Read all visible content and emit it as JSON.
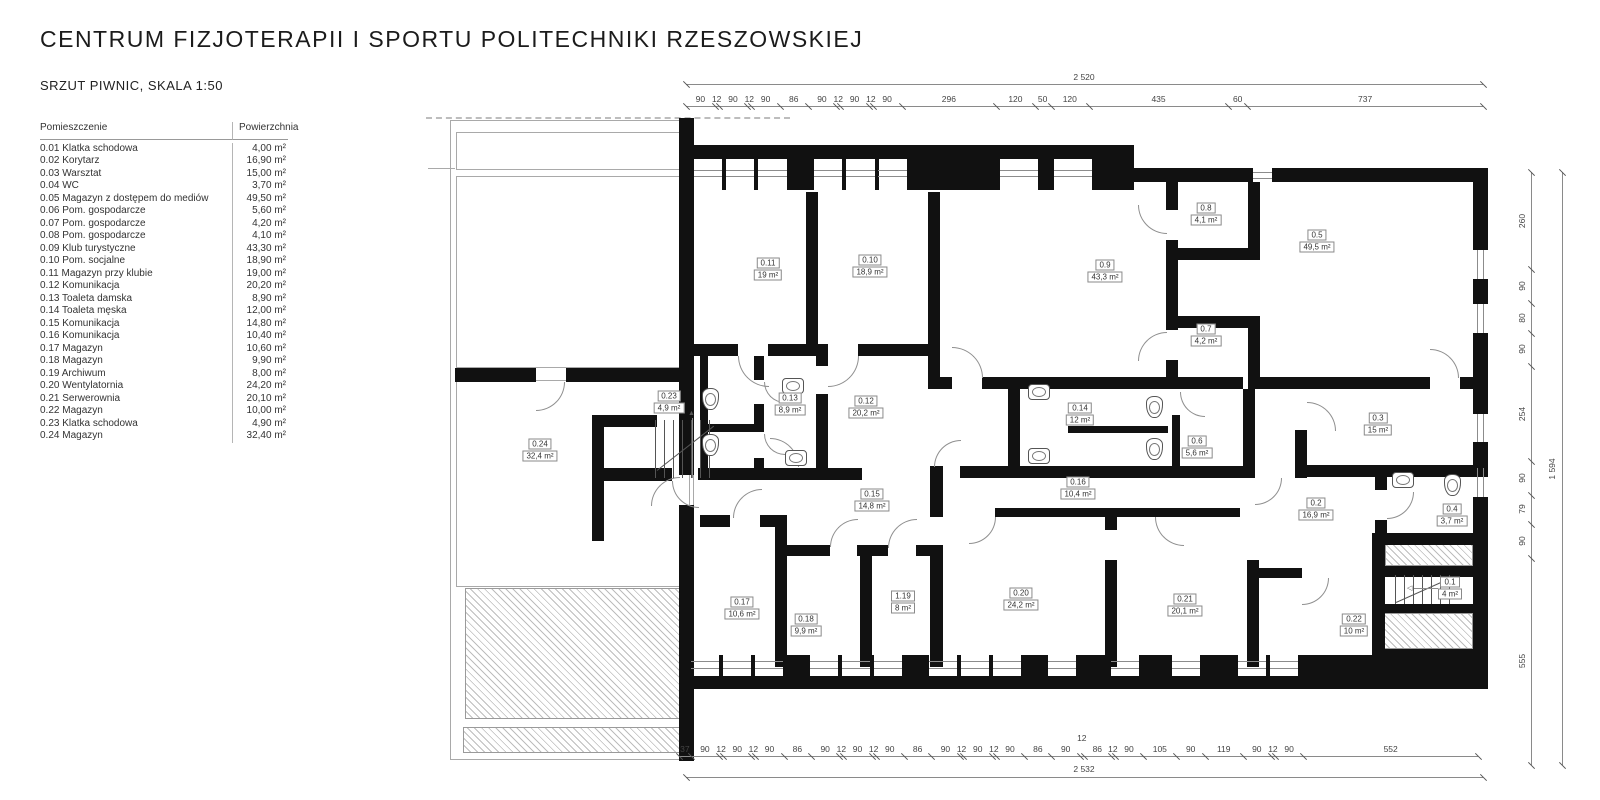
{
  "title": "CENTRUM FIZJOTERAPII I SPORTU POLITECHNIKI RZESZOWSKIEJ",
  "subtitle": "SRZUT PIWNIC, SKALA 1:50",
  "legend": {
    "headers": [
      "Pomieszczenie",
      "Powierzchnia"
    ],
    "rows": [
      {
        "id": "0.01",
        "name": "Klatka schodowa",
        "area": "4,00 m²"
      },
      {
        "id": "0.02",
        "name": "Korytarz",
        "area": "16,90 m²"
      },
      {
        "id": "0.03",
        "name": "Warsztat",
        "area": "15,00 m²"
      },
      {
        "id": "0.04",
        "name": "WC",
        "area": "3,70 m²"
      },
      {
        "id": "0.05",
        "name": "Magazyn z dostępem do mediów",
        "area": "49,50 m²"
      },
      {
        "id": "0.06",
        "name": "Pom. gospodarcze",
        "area": "5,60 m²"
      },
      {
        "id": "0.07",
        "name": "Pom. gospodarcze",
        "area": "4,20 m²"
      },
      {
        "id": "0.08",
        "name": "Pom. gospodarcze",
        "area": "4,10 m²"
      },
      {
        "id": "0.09",
        "name": "Klub turystyczne",
        "area": "43,30 m²"
      },
      {
        "id": "0.10",
        "name": "Pom. socjalne",
        "area": "18,90 m²"
      },
      {
        "id": "0.11",
        "name": "Magazyn przy klubie",
        "area": "19,00 m²"
      },
      {
        "id": "0.12",
        "name": "Komunikacja",
        "area": "20,20 m²"
      },
      {
        "id": "0.13",
        "name": "Toaleta damska",
        "area": "8,90 m²"
      },
      {
        "id": "0.14",
        "name": "Toaleta męska",
        "area": "12,00 m²"
      },
      {
        "id": "0.15",
        "name": "Komunikacja",
        "area": "14,80 m²"
      },
      {
        "id": "0.16",
        "name": "Komunikacja",
        "area": "10,40 m²"
      },
      {
        "id": "0.17",
        "name": "Magazyn",
        "area": "10,60 m²"
      },
      {
        "id": "0.18",
        "name": "Magazyn",
        "area": "9,90 m²"
      },
      {
        "id": "0.19",
        "name": "Archiwum",
        "area": "8,00 m²"
      },
      {
        "id": "0.20",
        "name": "Wentylatornia",
        "area": "24,20 m²"
      },
      {
        "id": "0.21",
        "name": "Serwerownia",
        "area": "20,10 m²"
      },
      {
        "id": "0.22",
        "name": "Magazyn",
        "area": "10,00 m²"
      },
      {
        "id": "0.23",
        "name": "Klatka schodowa",
        "area": "4,90 m²"
      },
      {
        "id": "0.24",
        "name": "Magazyn",
        "area": "32,40 m²"
      }
    ]
  },
  "plan": {
    "rooms": [
      {
        "id": "0.11",
        "area": "19 m²",
        "x": 768,
        "y": 269
      },
      {
        "id": "0.10",
        "area": "18,9 m²",
        "x": 870,
        "y": 266
      },
      {
        "id": "0.9",
        "area": "43,3 m²",
        "x": 1105,
        "y": 271
      },
      {
        "id": "0.8",
        "area": "4,1 m²",
        "x": 1206,
        "y": 214
      },
      {
        "id": "0.5",
        "area": "49,5 m²",
        "x": 1317,
        "y": 241
      },
      {
        "id": "0.7",
        "area": "4,2 m²",
        "x": 1206,
        "y": 335
      },
      {
        "id": "0.23",
        "area": "4,9 m²",
        "x": 669,
        "y": 402
      },
      {
        "id": "0.13",
        "area": "8,9 m²",
        "x": 790,
        "y": 404
      },
      {
        "id": "0.12",
        "area": "20,2 m²",
        "x": 866,
        "y": 407
      },
      {
        "id": "0.14",
        "area": "12 m²",
        "x": 1080,
        "y": 414
      },
      {
        "id": "0.6",
        "area": "5,6 m²",
        "x": 1197,
        "y": 447
      },
      {
        "id": "0.3",
        "area": "15 m²",
        "x": 1378,
        "y": 424
      },
      {
        "id": "0.24",
        "area": "32,4 m²",
        "x": 540,
        "y": 450
      },
      {
        "id": "0.16",
        "area": "10,4 m²",
        "x": 1078,
        "y": 488
      },
      {
        "id": "0.15",
        "area": "14,8 m²",
        "x": 872,
        "y": 500
      },
      {
        "id": "0.2",
        "area": "16,9 m²",
        "x": 1316,
        "y": 509
      },
      {
        "id": "0.4",
        "area": "3,7 m²",
        "x": 1452,
        "y": 515
      },
      {
        "id": "0.1",
        "area": "4 m²",
        "x": 1450,
        "y": 588
      },
      {
        "id": "0.17",
        "area": "10,6 m²",
        "x": 742,
        "y": 608
      },
      {
        "id": "0.18",
        "area": "9,9 m²",
        "x": 806,
        "y": 625
      },
      {
        "id": "1.19",
        "area": "8 m²",
        "x": 903,
        "y": 602
      },
      {
        "id": "0.20",
        "area": "24,2 m²",
        "x": 1021,
        "y": 599
      },
      {
        "id": "0.21",
        "area": "20,1 m²",
        "x": 1185,
        "y": 605
      },
      {
        "id": "0.22",
        "area": "10 m²",
        "x": 1354,
        "y": 625
      }
    ],
    "dims": {
      "top": {
        "total": "2 520",
        "segments": [
          90,
          12,
          90,
          12,
          90,
          86,
          90,
          12,
          90,
          12,
          90,
          296,
          120,
          50,
          120,
          435,
          60,
          737
        ]
      },
      "bottom": {
        "total": "2 532",
        "raised_index": 20,
        "segments": [
          37,
          90,
          12,
          90,
          12,
          90,
          86,
          90,
          12,
          90,
          12,
          90,
          86,
          90,
          12,
          90,
          12,
          90,
          86,
          90,
          12,
          86,
          12,
          90,
          105,
          90,
          119,
          90,
          12,
          90,
          552
        ]
      },
      "right": {
        "total": "1 594",
        "segments": [
          260,
          90,
          80,
          90,
          254,
          90,
          79,
          90,
          555
        ]
      }
    }
  }
}
